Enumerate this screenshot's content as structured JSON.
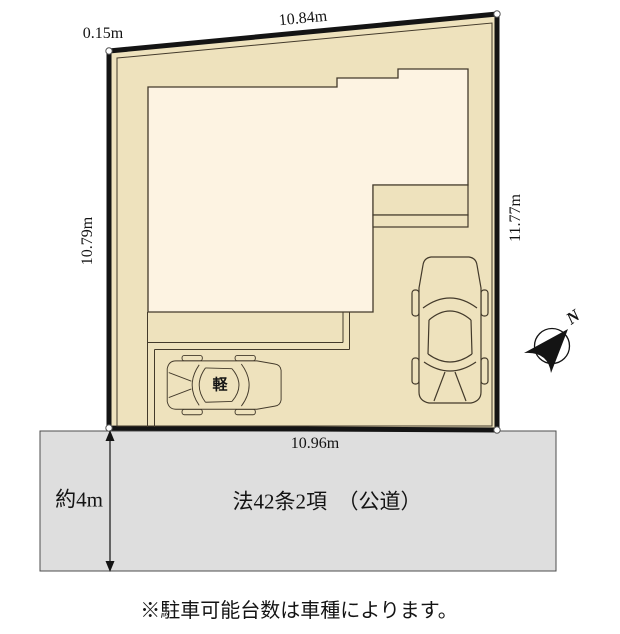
{
  "labels": {
    "dim_top": "10.84m",
    "dim_top_left": "0.15m",
    "dim_left": "10.79m",
    "dim_right": "11.77m",
    "dim_bottom": "10.96m",
    "road_width": "約4m",
    "road_name": "法42条2項　（公道）",
    "note": "※駐車可能台数は車種によります。",
    "kei_car": "軽",
    "compass_north": "N"
  },
  "colors": {
    "plot_fill": "#eee2bd",
    "building_fill": "#fdf3e2",
    "road_fill": "#dedede",
    "outline": "#141414",
    "line": "#433a2b",
    "road_border": "#4d4d4d",
    "marker_fill": "#ffffff",
    "marker_stroke": "#555555"
  }
}
